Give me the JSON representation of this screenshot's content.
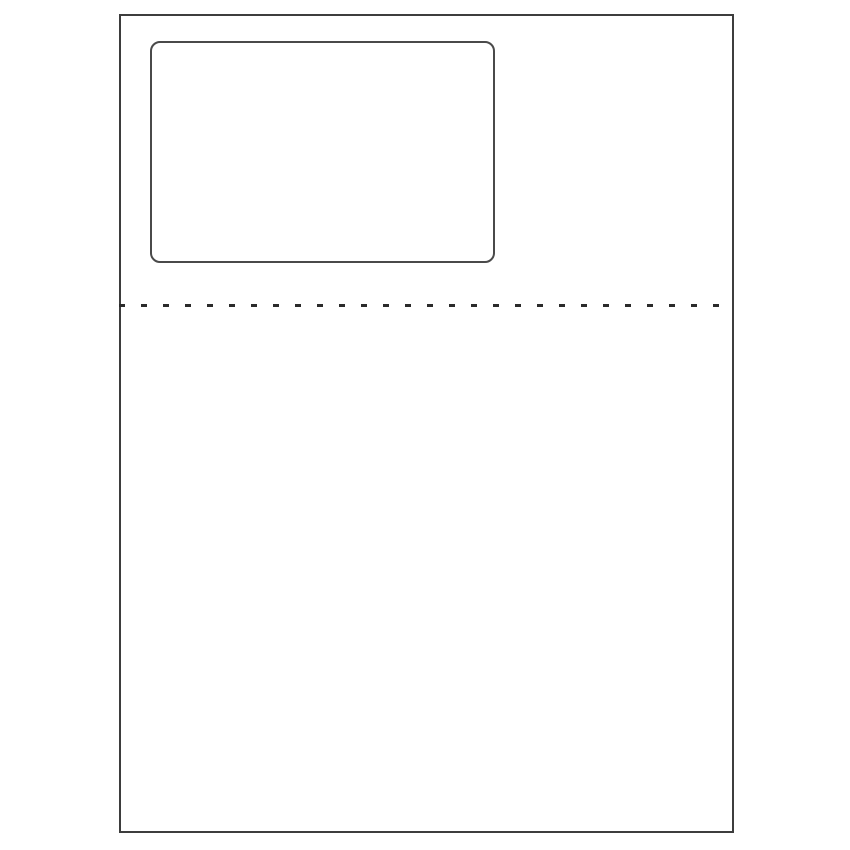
{
  "diagram": {
    "kind": "blank-label-sheet-template",
    "colors": {
      "background": "#ffffff",
      "sheet_border": "#3d3d3d",
      "label_border": "#4a4a4a",
      "perforation": "#2b2b2b"
    }
  }
}
